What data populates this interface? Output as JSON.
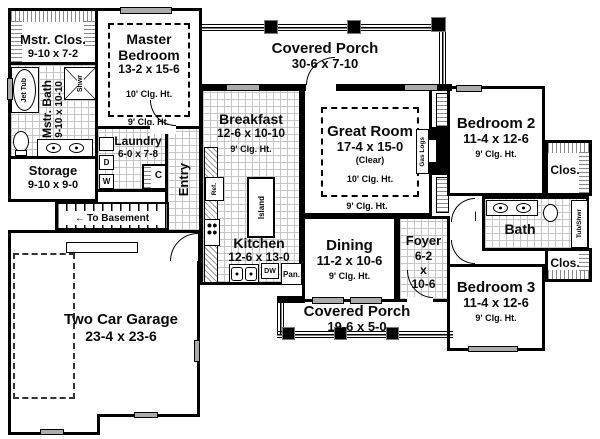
{
  "rooms": {
    "master_closet": {
      "name": "Mstr. Clos.",
      "dims": "9-10 x 7-2"
    },
    "master_bedroom": {
      "name": "Master Bedroom",
      "dims": "13-2 x 15-6",
      "ceiling": "10' Clg. Ht.",
      "ceiling_outer": "9' Clg. Ht."
    },
    "master_bath": {
      "name": "Mstr. Bath",
      "dims": "9-10 x 10-10"
    },
    "laundry": {
      "name": "Laundry",
      "dims": "6-0 x 7-8"
    },
    "storage": {
      "name": "Storage",
      "dims": "9-10 x 9-0"
    },
    "garage": {
      "name": "Two Car Garage",
      "dims": "23-4 x 23-6"
    },
    "porch_top": {
      "name": "Covered Porch",
      "dims": "30-6 x 7-10"
    },
    "breakfast": {
      "name": "Breakfast",
      "dims": "12-6 x 10-10",
      "ceiling": "9' Clg. Ht."
    },
    "kitchen": {
      "name": "Kitchen",
      "dims": "12-6 x 13-0"
    },
    "great_room": {
      "name": "Great Room",
      "dims": "17-4 x 15-0",
      "clear": "(Clear)",
      "ceiling": "10' Clg. Ht.",
      "ceiling_outer": "9' Clg. Ht."
    },
    "dining": {
      "name": "Dining",
      "dims": "11-2 x 10-6",
      "ceiling": "9' Clg. Ht."
    },
    "foyer": {
      "name": "Foyer",
      "dims1": "6-2",
      "dims2": "x",
      "dims3": "10-6"
    },
    "porch_bottom": {
      "name": "Covered Porch",
      "dims": "19-6 x 5-0"
    },
    "hall": {
      "name": "Hall"
    },
    "bath": {
      "name": "Bath"
    },
    "bedroom2": {
      "name": "Bedroom 2",
      "dims": "11-4 x 12-6",
      "ceiling": "9' Clg. Ht."
    },
    "bedroom3": {
      "name": "Bedroom 3",
      "dims": "11-4 x 12-6",
      "ceiling": "9' Clg. Ht."
    },
    "closet_upper": {
      "name": "Clos."
    },
    "closet_lower": {
      "name": "Clos."
    },
    "entry": {
      "name": "Entry"
    }
  },
  "fixtures": {
    "jet_tub": "Jet Tub",
    "shower": "Shwr",
    "tub_shower": "Tub/Shwr",
    "gas_logs": "Gas Logs",
    "island": "Island",
    "refrigerator": "Ref.",
    "dishwasher": "DW",
    "pantry": "Pan.",
    "washer": "W",
    "dryer": "D",
    "closet_c": "C",
    "to_basement": "To Basement",
    "basement_arrow": "←"
  },
  "colors": {
    "wall": "#000000",
    "floor": "#ffffff",
    "tile_grid": "#c6c6c6",
    "window": "#ababab"
  }
}
